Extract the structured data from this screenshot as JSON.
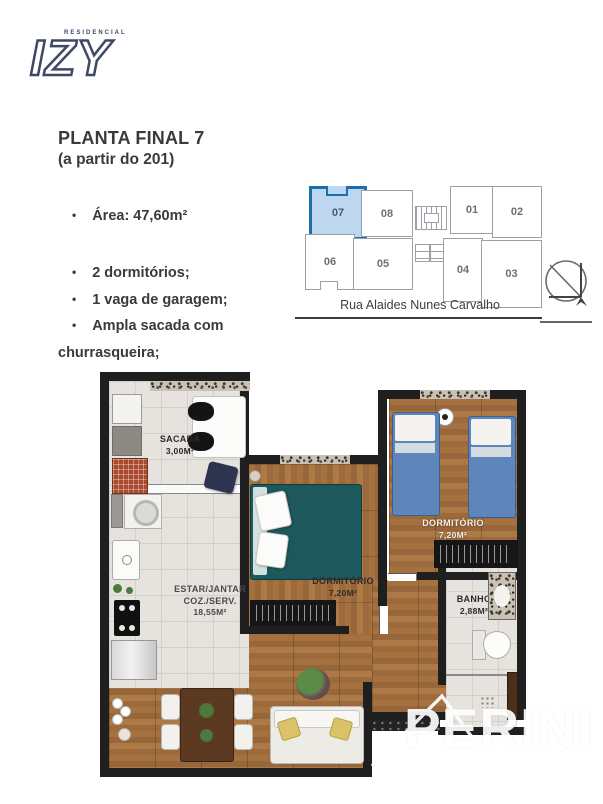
{
  "logo": {
    "sub": "RESIDENCIAL",
    "brand": "IZY"
  },
  "info": {
    "title": "PLANTA FINAL 7",
    "subtitle": "(a partir do 201)",
    "bullet_area": "Área: 47,60m²",
    "bullets": [
      "2 dormitórios;",
      "1 vaga de garagem;",
      "Ampla sacada com churrasqueira;"
    ]
  },
  "keyplan": {
    "units": [
      {
        "id": "07"
      },
      {
        "id": "08"
      },
      {
        "id": "01"
      },
      {
        "id": "02"
      },
      {
        "id": "06"
      },
      {
        "id": "05"
      },
      {
        "id": "04"
      },
      {
        "id": "03"
      }
    ],
    "highlighted_unit": "07",
    "street": "Rua Alaides Nunes Carvalho"
  },
  "floorplan": {
    "sacada": {
      "name": "SACADA",
      "area": "3,00M²"
    },
    "living": {
      "line1": "ESTAR/JANTAR",
      "line2": "COZ./SERV.",
      "area": "18,55M²"
    },
    "dorm1": {
      "name": "DORMITÓRIO",
      "area": "7,20M²"
    },
    "dorm2": {
      "name": "DORMITÓRIO",
      "area": "7,20M²"
    },
    "banho": {
      "name": "BANHO",
      "area": "2,88M²"
    }
  },
  "watermark": {
    "text": "PERINI"
  },
  "colors": {
    "accent_blue": "#1c6fad",
    "unit_fill": "#bdd7f1",
    "wood": "#9c6a3c",
    "bed_teal": "#1d585c",
    "bed_blue": "#5f86ba",
    "wall": "#1f1f1f"
  }
}
